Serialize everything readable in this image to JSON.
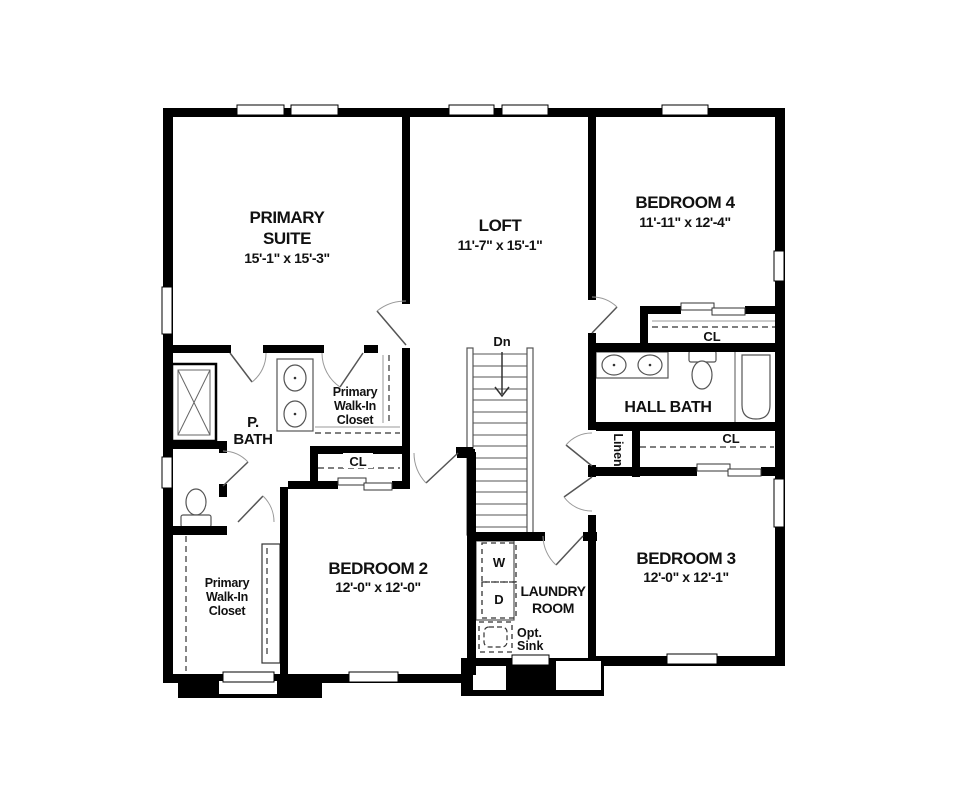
{
  "rooms": {
    "primary_suite": {
      "lines": [
        "PRIMARY",
        "SUITE"
      ],
      "dims": "15'-1\" x 15'-3\""
    },
    "loft": {
      "name": "LOFT",
      "dims": "11'-7\" x 15'-1\""
    },
    "bedroom_4": {
      "name": "BEDROOM 4",
      "dims": "11'-11\" x 12'-4\""
    },
    "bedroom_2": {
      "name": "BEDROOM 2",
      "dims": "12'-0\" x 12'-0\""
    },
    "bedroom_3": {
      "name": "BEDROOM 3",
      "dims": "12'-0\" x 12'-1\""
    },
    "primary_bath": {
      "lines": [
        "P.",
        "BATH"
      ]
    },
    "hall_bath": {
      "name": "HALL BATH"
    },
    "laundry": {
      "lines": [
        "LAUNDRY",
        "ROOM"
      ]
    },
    "linen": {
      "name": "Linen"
    },
    "primary_walk_in_closet_upper": {
      "lines": [
        "Primary",
        "Walk-In",
        "Closet"
      ]
    },
    "primary_walk_in_closet_lower": {
      "lines": [
        "Primary",
        "Walk-In",
        "Closet"
      ]
    },
    "closets": {
      "bedroom_2": "CL",
      "bedroom_4": "CL",
      "bedroom_3": "CL"
    }
  },
  "stairs": {
    "label": "Dn"
  },
  "appliances": {
    "washer": "W",
    "dryer": "D",
    "opt_sink_lines": [
      "Opt.",
      "Sink"
    ]
  },
  "colors": {
    "wall": "#000000",
    "fixture_line": "#555555",
    "background": "#ffffff"
  }
}
